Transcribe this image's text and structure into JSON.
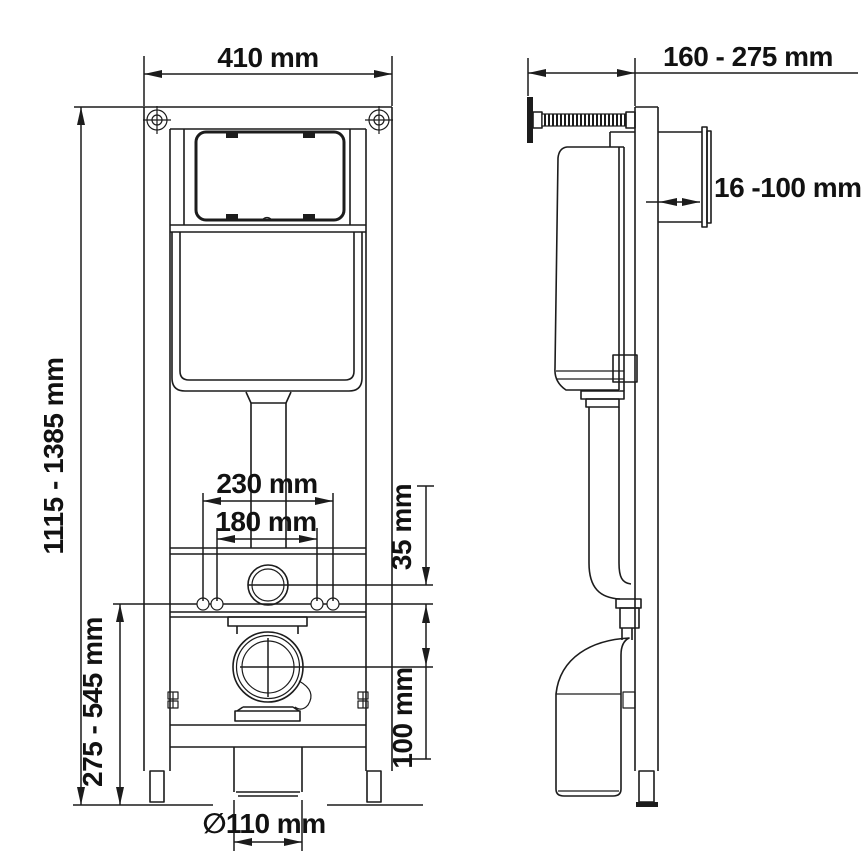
{
  "drawing": {
    "background": "#ffffff",
    "line_color": "#1c1c1c",
    "type": "installation frame technical drawing, front and side views",
    "dimensions": {
      "frame_width": "410 mm",
      "frame_height_range": "1115 - 1385 mm",
      "lower_height_range": "275 - 545 mm",
      "fixing_spacing_outer": "230 mm",
      "fixing_spacing_inner": "180 mm",
      "flush_to_fixing_offset": "35 mm",
      "fixing_to_outlet_offset": "100 mm",
      "outlet_diameter": "∅110 mm",
      "depth_range": "160 - 275 mm",
      "plate_depth_range": "16 -100 mm"
    }
  }
}
